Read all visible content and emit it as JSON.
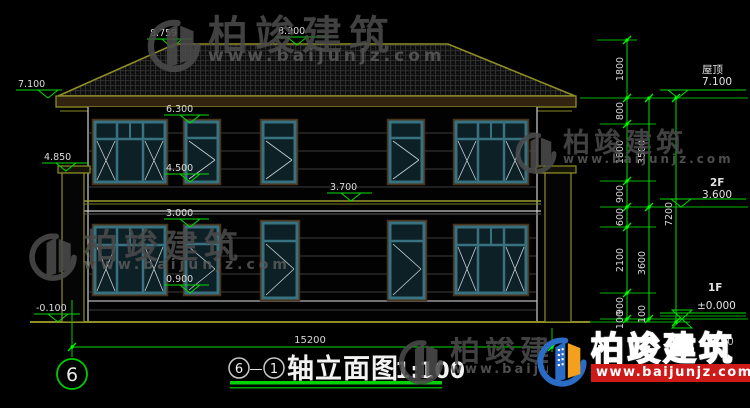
{
  "watermark": {
    "brand": "柏竣建筑",
    "url": "www.baijunjz.com"
  },
  "logo": {
    "brand": "柏竣建筑",
    "url": "www.baijunjz.com"
  },
  "title_block": {
    "axis_from": "6",
    "dash": "—",
    "axis_to": "1",
    "name": "轴立面图",
    "scale": "1:100"
  },
  "axis": {
    "bubble_left": "6"
  },
  "levels": {
    "ridge_hip": "8.759",
    "ridge": "8.900",
    "eave": "7.100",
    "win2f_top": "6.300",
    "pillar_top": "4.850",
    "win2f_sill": "4.500",
    "band": "3.700",
    "win1f_top": "3.000",
    "win1f_sill": "0.900",
    "ground": "-0.100"
  },
  "right_labels": {
    "roof_label": "屋顶",
    "roof_value": "7.100",
    "f2_label": "2F",
    "f2_value": "3.600",
    "f1_label": "1F",
    "f1_value": "±0.000",
    "below_value": "-0.100"
  },
  "dims": {
    "col1": [
      "1800",
      "800",
      "1800",
      "900",
      "600",
      "2100",
      "900",
      "100"
    ],
    "col2": [
      "3500",
      "3600",
      "100"
    ],
    "col3": [
      "7200"
    ],
    "total_width": "15200"
  }
}
